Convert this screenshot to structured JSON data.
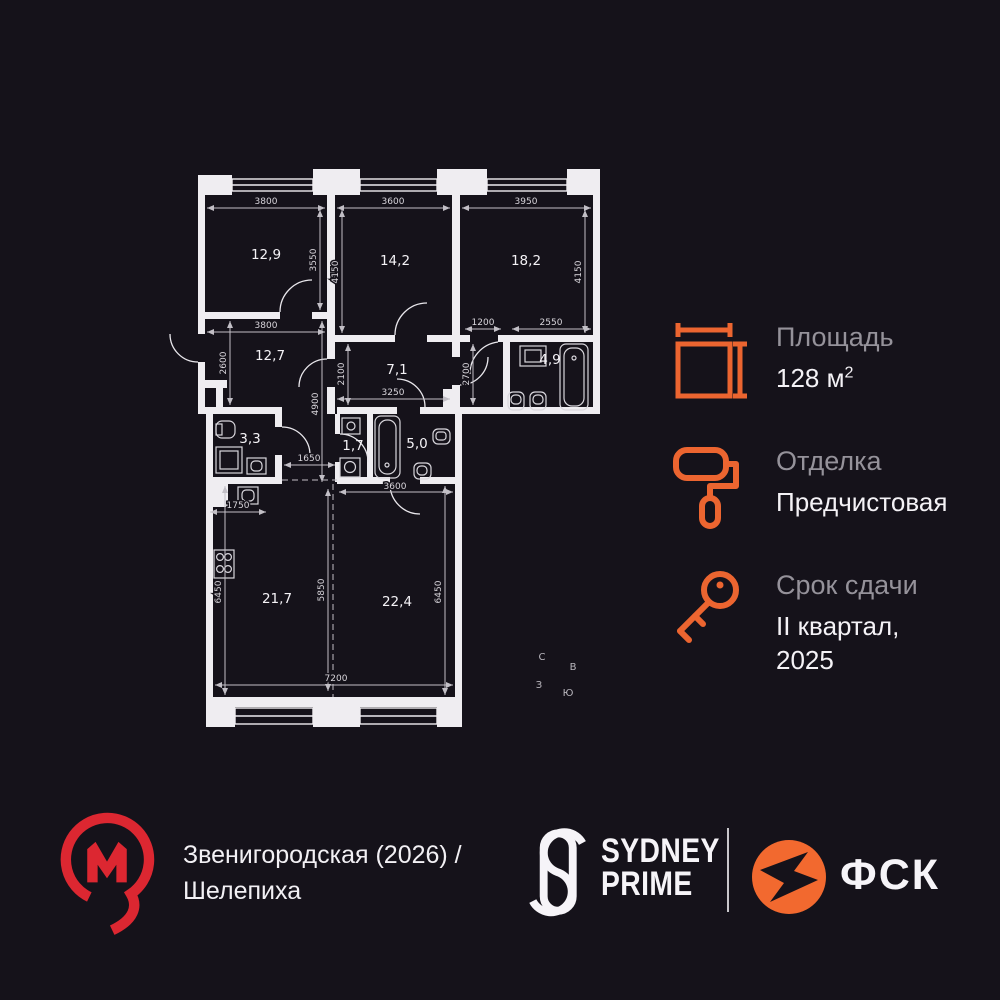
{
  "colors": {
    "background": "#15121a",
    "wall_white": "#efedf1",
    "accent_orange": "#EC6530",
    "metro_red": "#DC2731",
    "label_gray": "#95929a",
    "text_white": "#f4f2f6"
  },
  "plan": {
    "rooms": {
      "r129": "12,9",
      "r142": "14,2",
      "r182": "18,2",
      "r127": "12,7",
      "r71": "7,1",
      "r49": "4,9",
      "r33": "3,3",
      "r17": "1,7",
      "r50": "5,0",
      "r217": "21,7",
      "r224": "22,4"
    },
    "dims": {
      "w129": "3800",
      "w142": "3600",
      "w182": "3950",
      "h129": "3550",
      "h142": "4150",
      "h182": "4150",
      "w127": "3800",
      "wcorr": "1200",
      "w49": "2550",
      "h127": "2600",
      "h71": "2100",
      "h49": "2700",
      "hhall": "4900",
      "w71": "3250",
      "whall": "1650",
      "wniche": "1750",
      "w224": "3600",
      "h217": "6450",
      "hmid": "5850",
      "h224": "6450",
      "wbottom": "7200"
    },
    "compass": {
      "north": "С",
      "east": "В",
      "west": "З",
      "south": "Ю"
    }
  },
  "info": {
    "items": [
      {
        "label": "Площадь",
        "value": "128 м",
        "sup": "2"
      },
      {
        "label": "Отделка",
        "value": "Предчистовая",
        "sup": ""
      },
      {
        "label": "Срок сдачи",
        "value": "II квартал, 2025",
        "sup": ""
      }
    ],
    "icons": [
      "area-measure-icon",
      "paint-roller-icon",
      "key-icon"
    ]
  },
  "footer": {
    "station": "Звенигородская (2026) / Шелепиха",
    "brand_top": "SYDNEY",
    "brand_bottom": "PRIME",
    "partner": "ФСК"
  }
}
